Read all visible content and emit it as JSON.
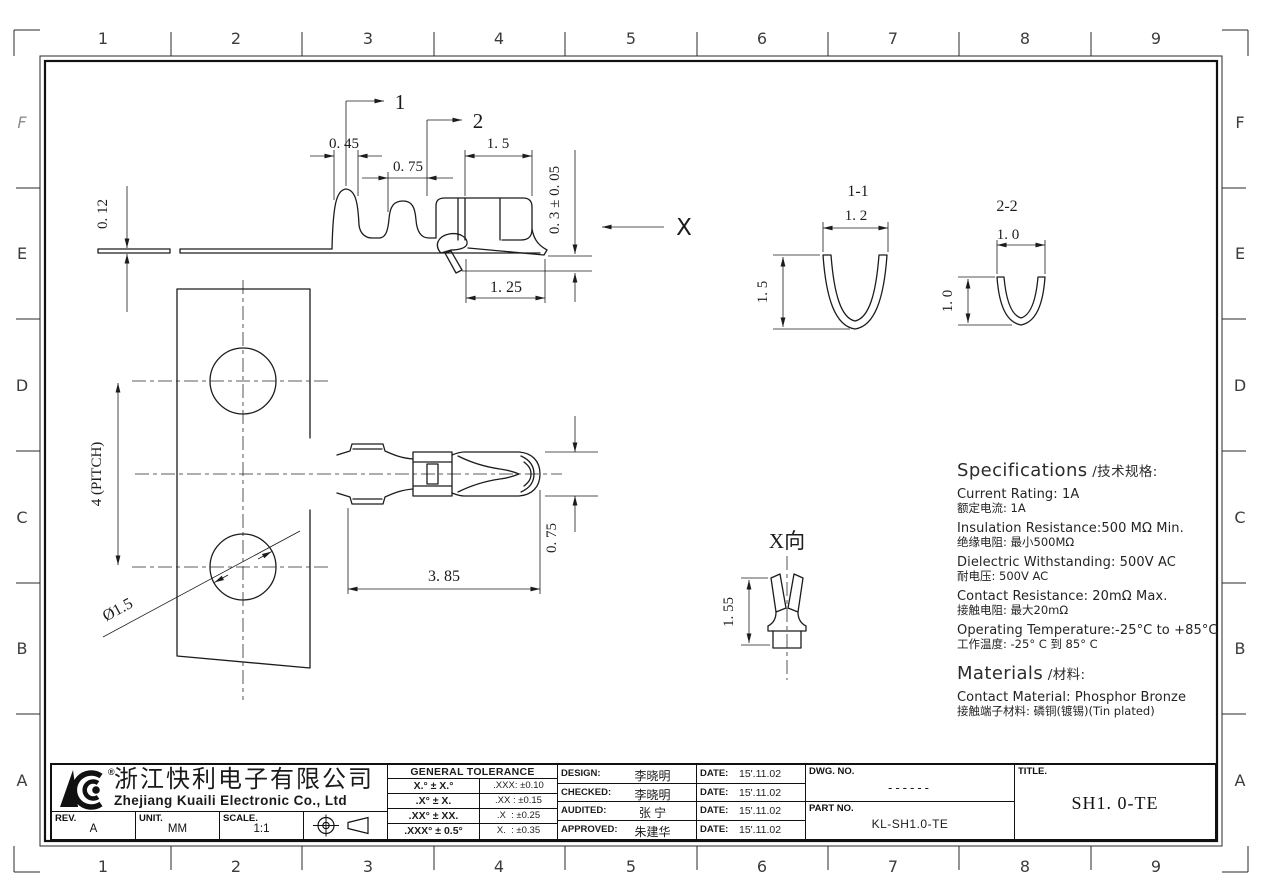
{
  "border": {
    "columns": [
      "1",
      "2",
      "3",
      "4",
      "5",
      "6",
      "7",
      "8",
      "9"
    ],
    "rows": [
      "F",
      "E",
      "D",
      "C",
      "B",
      "A"
    ]
  },
  "side_view": {
    "callout1": "1",
    "callout2": "2",
    "dim_012": "0. 12",
    "dim_045": "0. 45",
    "dim_075": "0. 75",
    "dim_15": "1. 5",
    "dim_03": "0. 3 ± 0. 05",
    "dim_125": "1. 25",
    "x_label": "X"
  },
  "section11": {
    "title": "1-1",
    "dim_w": "1. 2",
    "dim_h": "1. 5"
  },
  "section22": {
    "title": "2-2",
    "dim_w": "1. 0",
    "dim_h": "1. 0"
  },
  "plan_view": {
    "dim_pitch": "4 (PITCH)",
    "dim_dia": "Ø1.5",
    "dim_385": "3. 85",
    "dim_075": "0. 75"
  },
  "x_view": {
    "title": "X向",
    "dim_155": "1. 55"
  },
  "specs": {
    "title_en": "Specifications",
    "title_zh": " /技术规格:",
    "items": [
      {
        "en": "Current Rating: 1A",
        "zh": "额定电流: 1A"
      },
      {
        "en": "Insulation Resistance:500 MΩ Min.",
        "zh": "绝缘电阻: 最小500MΩ"
      },
      {
        "en": "Dielectric Withstanding: 500V AC",
        "zh": "耐电压: 500V AC"
      },
      {
        "en": "Contact Resistance: 20mΩ Max.",
        "zh": "接触电阻: 最大20mΩ"
      },
      {
        "en": "Operating Temperature:-25°C to +85°C",
        "zh": "工作温度: -25° C 到 85° C"
      }
    ],
    "materials_title_en": "Materials",
    "materials_title_zh": " /材料:",
    "materials": [
      {
        "en": "Contact Material: Phosphor Bronze",
        "zh": "接触端子材料: 磷铜(镀锡)(Tin plated)"
      }
    ]
  },
  "title_block": {
    "company_zh": "浙江快利电子有限公司",
    "company_en": "Zhejiang Kuaili Electronic Co., Ltd",
    "reg_mark": "®",
    "rev_label": "REV.",
    "rev": "A",
    "unit_label": "UNIT.",
    "unit": "MM",
    "scale_label": "SCALE.",
    "scale": "1:1",
    "tol_header": "GENERAL TOLERANCE",
    "tol_rows": [
      {
        "range": "X.° ± X.°",
        "value": ".XXX: ±0.10"
      },
      {
        "range": ".X° ± X.",
        "value": ".XX : ±0.15"
      },
      {
        "range": ".XX° ± XX.",
        "value": ".X  : ±0.25"
      },
      {
        "range": ".XXX° ± 0.5°",
        "value": "X.  : ±0.35"
      }
    ],
    "approvals": [
      {
        "label": "DESIGN:",
        "name": "李晓明",
        "date_label": "DATE:",
        "date": "15'.11.02"
      },
      {
        "label": "CHECKED:",
        "name": "李晓明",
        "date_label": "DATE:",
        "date": "15'.11.02"
      },
      {
        "label": "AUDITED:",
        "name": "张 宁",
        "date_label": "DATE:",
        "date": "15'.11.02"
      },
      {
        "label": "APPROVED:",
        "name": "朱建华",
        "date_label": "DATE:",
        "date": "15'.11.02"
      }
    ],
    "dwg_no_label": "DWG. NO.",
    "dwg_no": "------",
    "part_no_label": "PART NO.",
    "part_no": "KL-SH1.0-TE",
    "title_label": "TITLE.",
    "title": "SH1. 0-TE"
  }
}
